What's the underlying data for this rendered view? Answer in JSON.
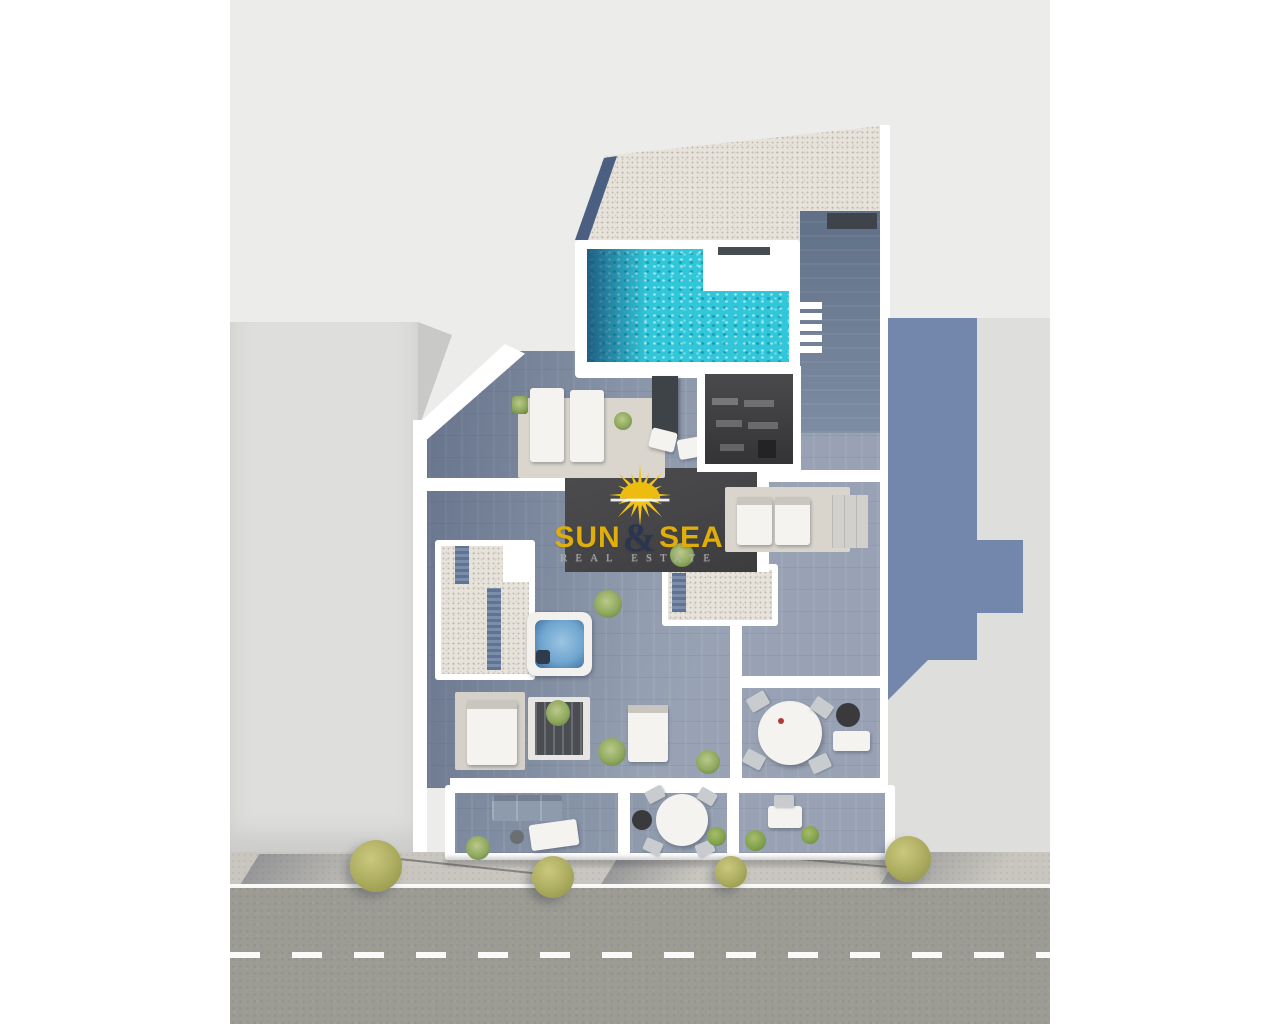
{
  "watermark": {
    "brand_sun": "SUN",
    "brand_amp": "&",
    "brand_sea": "SEA",
    "tagline": "REAL ESTATE",
    "sun_icon": "sun-rays-icon"
  },
  "palette": {
    "backdrop": "#ECECEB",
    "canvas": "#FFFFFF",
    "brand_gold": "#DFAE0C",
    "brand_navy": "#2A3550",
    "tagline_gray": "#A9A9A7",
    "pool_water": "#2FC7D9",
    "pool_deep": "#1F5F86",
    "wood_floor": "#8C98AB",
    "wood_dark": "#76869D",
    "gravel": "#E7E3DB",
    "charcoal_roof": "#454547",
    "neighbor_building": "#DEDEDC",
    "cast_shadow": "#6B82A8",
    "sidewalk": "#C8C6BE",
    "road": "#9D9C94",
    "road_marking": "#FFFFFF",
    "tree_foliage": "#ABAB5E",
    "jacuzzi_water": "#6FA6CF"
  }
}
